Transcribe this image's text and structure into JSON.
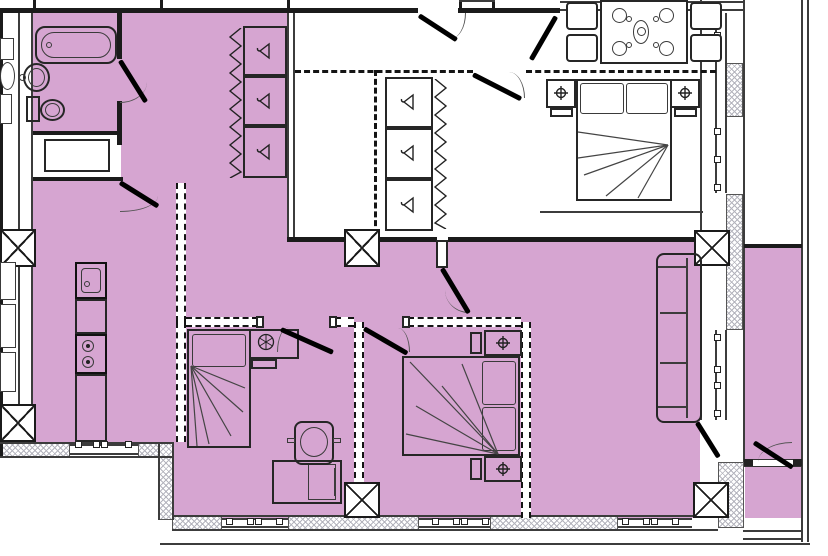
{
  "app": {
    "type": "architectural-floor-plan",
    "title": "Apartment floor plan with highlighted (pink) unit area"
  },
  "colors": {
    "floor_highlight": "#d6a5d1",
    "wall": "#1b1b1b",
    "line": "#3c3c3c",
    "hatch": "#b4b4bd",
    "door": "#000000",
    "paper": "#ffffff"
  },
  "rooms": [
    {
      "id": "bathroom",
      "label": "Bathroom"
    },
    {
      "id": "wc",
      "label": "WC / laundry"
    },
    {
      "id": "hallway",
      "label": "Hallway"
    },
    {
      "id": "entry",
      "label": "Entry"
    },
    {
      "id": "master-bedroom",
      "label": "Master bedroom"
    },
    {
      "id": "dining-area",
      "label": "Dining area"
    },
    {
      "id": "kitchen-living",
      "label": "Kitchen / living room"
    },
    {
      "id": "bedroom-1",
      "label": "Bedroom 1"
    },
    {
      "id": "bedroom-2",
      "label": "Bedroom 2"
    },
    {
      "id": "balcony",
      "label": "Balcony"
    }
  ],
  "furniture": [
    "bathtub",
    "wash-basin",
    "toilet",
    "shower-tray",
    "wardrobe",
    "clothes-rail",
    "dining-table",
    "dining-chair",
    "plate-setting",
    "double-bed",
    "nightstand",
    "table-lamp",
    "single-bed",
    "desk",
    "office-chair",
    "sofa",
    "kitchen-sink",
    "cooktop",
    "ventilation-shaft",
    "window",
    "door"
  ],
  "icons": {
    "hanger": "triangle-with-hook",
    "table_lamp": "circled-cross",
    "ventilation_shaft": "crossed-box",
    "cooktop": "two-burner-circles",
    "clothes_rail": "zigzag-profile"
  }
}
